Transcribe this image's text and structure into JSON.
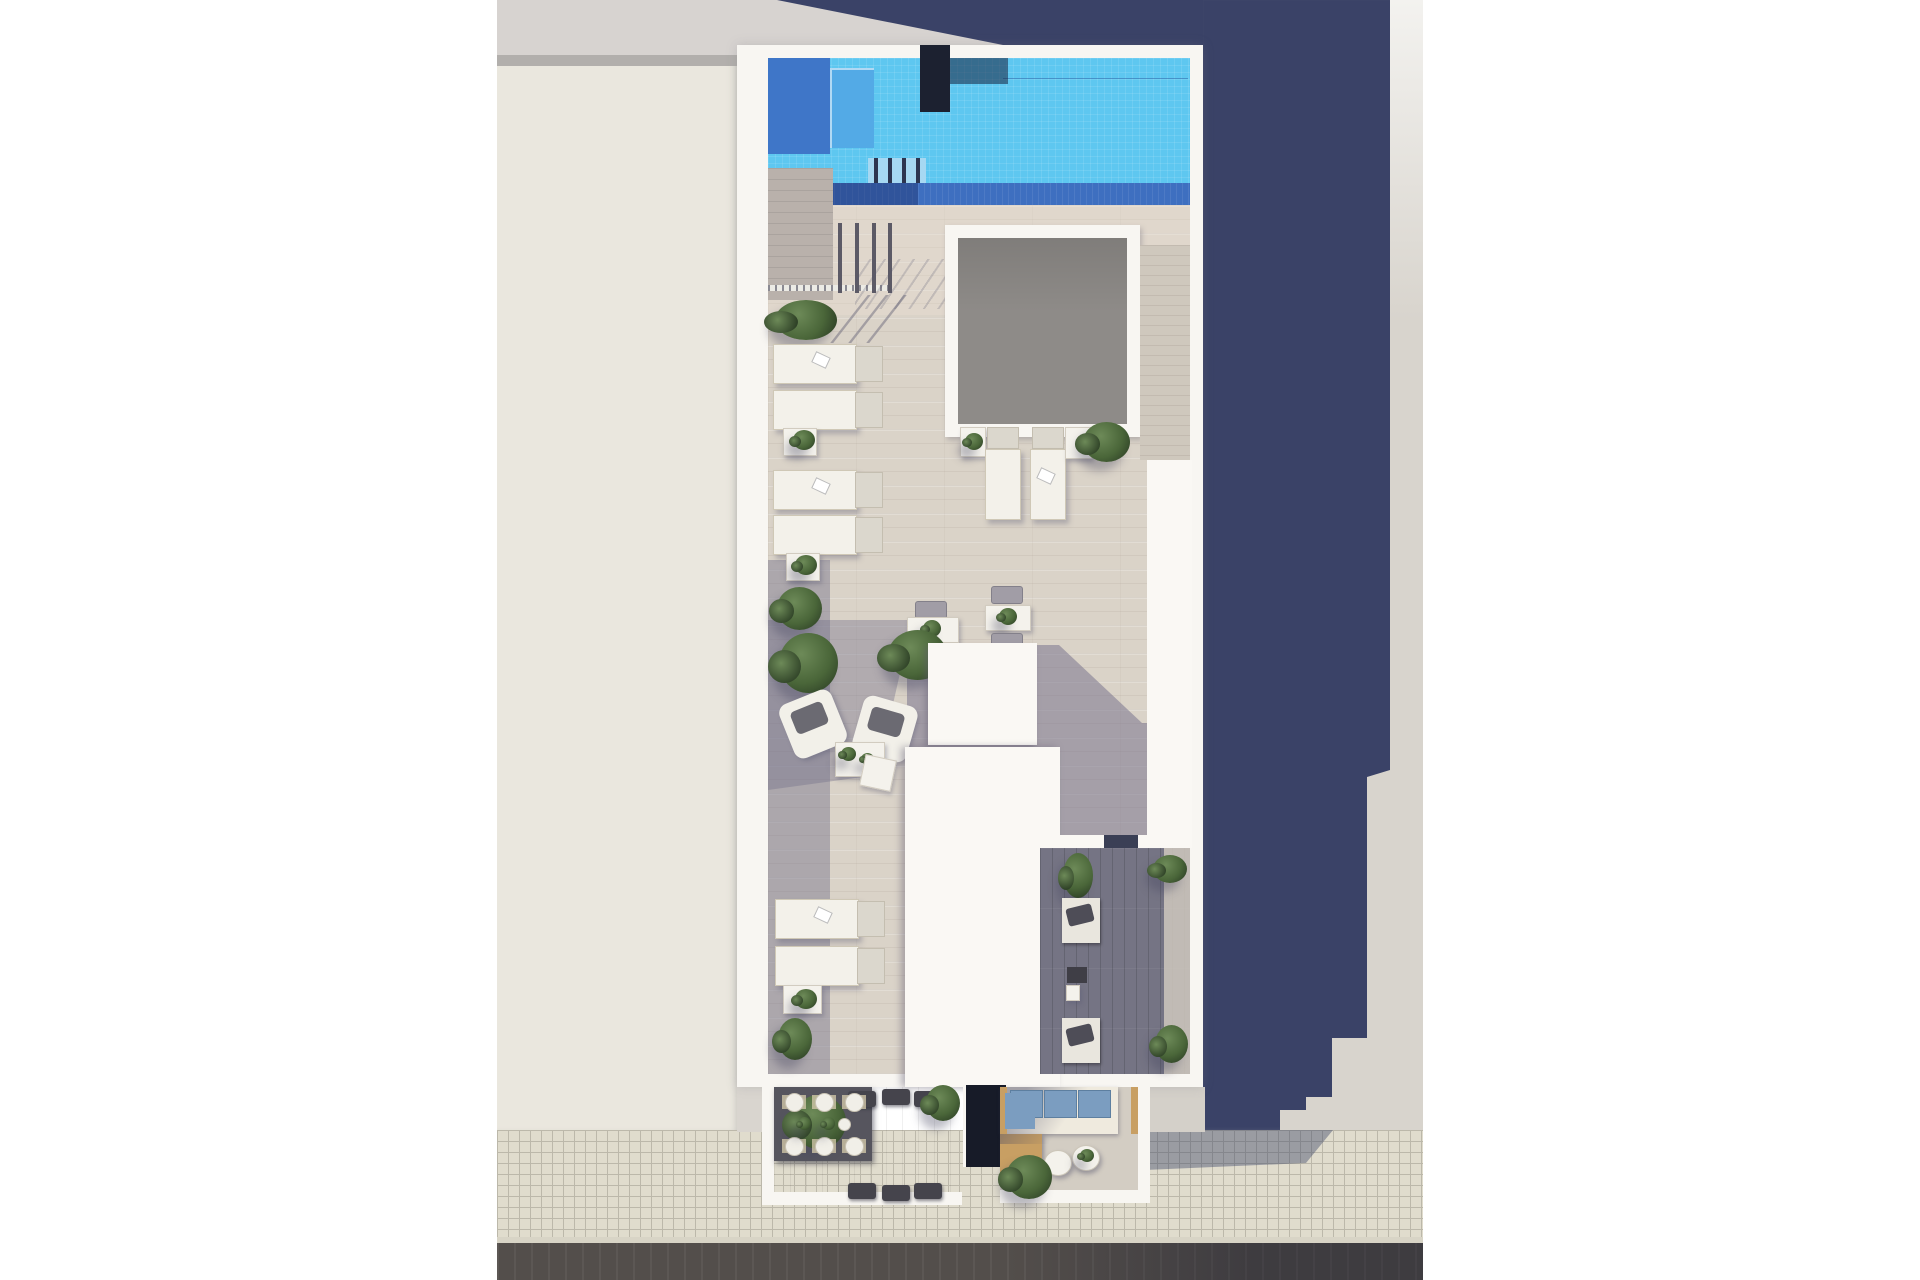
{
  "scene": {
    "type": "architectural-render-top-view",
    "subject": "Rooftop solarium floor plan with swimming pool, sun deck, skylight and two street-level terraces",
    "areas": [
      {
        "name": "swimming-pool",
        "position": "top of roof"
      },
      {
        "name": "skylight-courtyard",
        "position": "center-right, gray opening"
      },
      {
        "name": "sun-deck",
        "position": "center, wood-look tiles"
      },
      {
        "name": "lounge-seating-area",
        "position": "mid-left"
      },
      {
        "name": "dining-terrace",
        "position": "bottom-left, street level"
      },
      {
        "name": "sofa-terrace",
        "position": "bottom-right, street level"
      },
      {
        "name": "shaded-side-terrace",
        "position": "lower right of roof"
      },
      {
        "name": "street",
        "position": "bottom edge: sidewalk, curb, road"
      }
    ],
    "inventory": {
      "sun_loungers_flat": 8,
      "pool_ladder_posts": 4,
      "railing_posts": 4,
      "armchairs": 2,
      "bistro_tables": 2,
      "bistro_chairs": 4,
      "dining_table_seats": 6,
      "dining_place_settings": 6,
      "outdoor_sofa": 1,
      "sofa_cushions": 3,
      "daybeds_shaded_terrace": 2,
      "round_side_tables": 2,
      "wooden_lounger_with_blue_pad": 1,
      "side_tables_with_plants": 5,
      "planter_bushes": 12
    }
  },
  "palette": {
    "bg-white": "#ffffff",
    "neighbor-beige": "#eae7de",
    "neighbor-gray": "#d7d3d0",
    "neighbor-band": "#b2afac",
    "ground-light": "#d8d4cd",
    "shadow-navy": "#3a4267",
    "plan-wall": "#f8f6f2",
    "roof-white": "#faf8f4",
    "pool-light": "#5ec7f0",
    "pool-mid": "#3f76c8",
    "pool-step": "#53aae6",
    "pool-dark": "#3e6fc0",
    "chimney": "#1c2130",
    "deck-sun": "#dad3c8",
    "deck-shade": "#74708a",
    "deck-dark": "#757484",
    "shower-deck": "#b9b1ab",
    "wood-strip": "#cfc8bd",
    "courtyard": "#8e8b88",
    "lounger-pad": "#f3f1ea",
    "plant-light": "#6d8a58",
    "plant-mid": "#4a6639",
    "plant-dark": "#2f4227",
    "terrace-shade": "#a9a3ae",
    "terrace-sun": "#d3cdc3",
    "dining-table": "#56555e",
    "dining-chair": "#45444c",
    "cushion-blue": "#7b9dc0",
    "wood": "#c89f63",
    "door-dark": "#171b28",
    "sidewalk": "#e0dccd",
    "sidewalk-line": "#bcb8aa",
    "curb": "#d8d4c6",
    "road": "#534e4b"
  }
}
